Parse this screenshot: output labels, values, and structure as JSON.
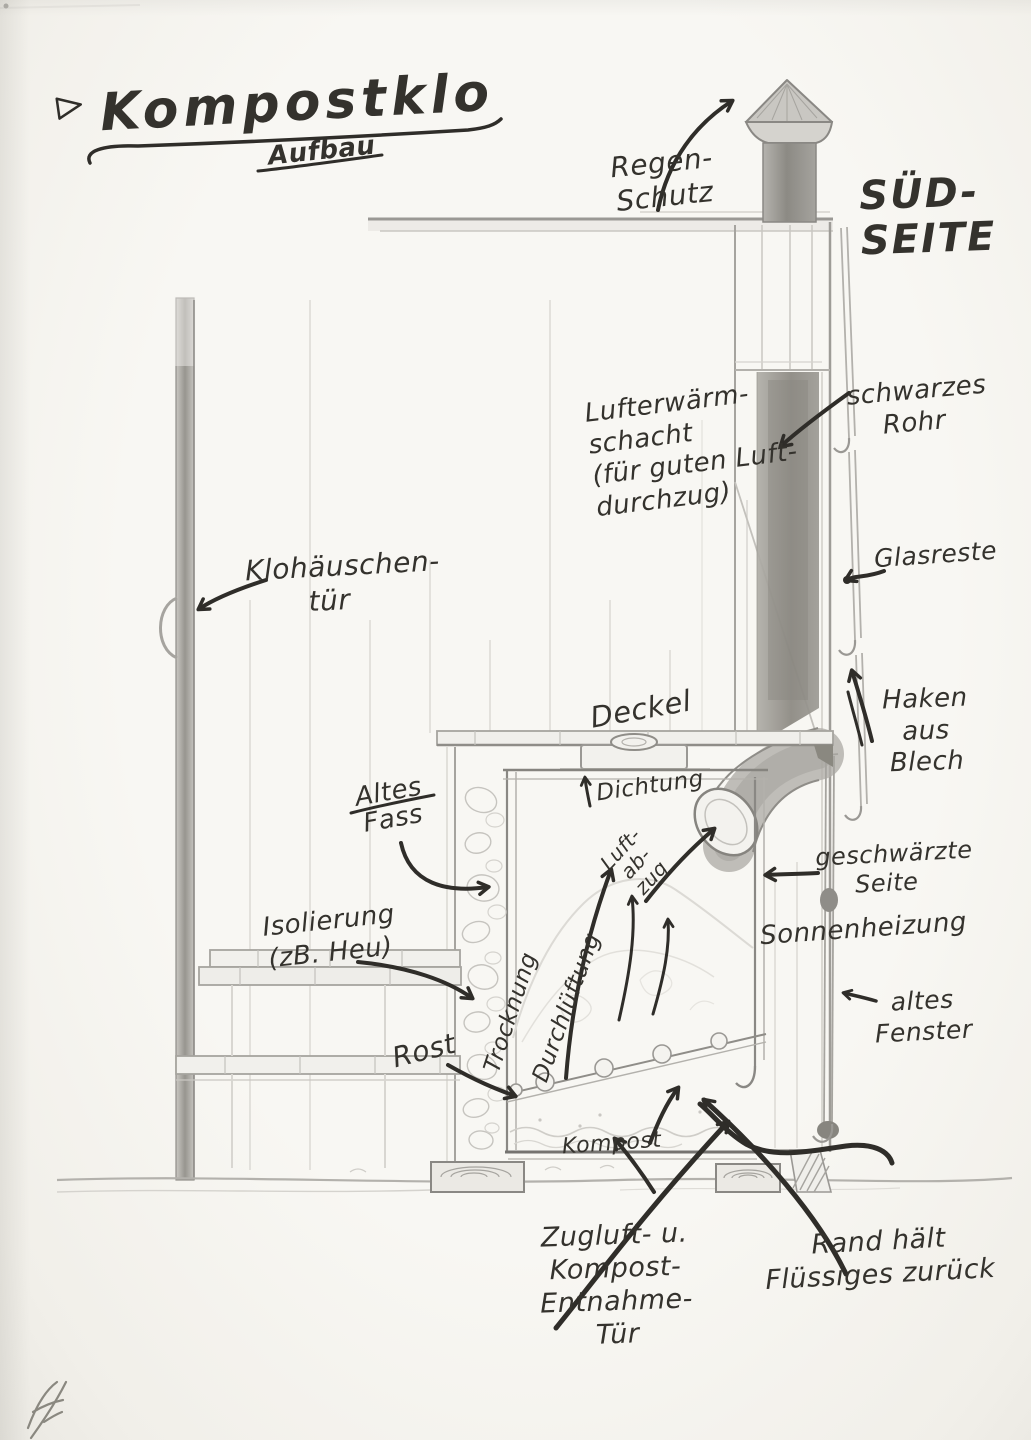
{
  "page": {
    "title": "Kompostklo",
    "subtitle": "Aufbau",
    "side_heading": "SÜD-\nSEITE"
  },
  "labels": {
    "regen_schutz": "Regen-\nSchutz",
    "lufterwaermschacht": "Lufterwärm-\nschacht\n(für guten Luft-\ndurchzug)",
    "schwarzes_rohr": "schwarzes\nRohr",
    "glasreste": "Glasreste",
    "klohaeuschen_tuer": "Klohäuschen-\ntür",
    "haken_aus_blech": "Haken aus\nBlech",
    "deckel": "Deckel",
    "dichtung": "Dichtung",
    "altes_fass": "Altes\nFass",
    "luft_abzug": "Luft-\nab-\nzug",
    "geschwaerzte_seite": "geschwärzte\nSeite",
    "sonnenheizung": "Sonnenheizung",
    "isolierung": "Isolierung\n(zB. Heu)",
    "trocknung": "Trocknung",
    "durchlueftung": "Durchlüftung",
    "altes_fenster": "altes\nFenster",
    "rost": "Rost",
    "kompost": "Kompost",
    "zugluft_entnahme_tuer": "Zugluft- u.\nKompost-Entnahme-\nTür",
    "rand_haelt": "Rand hält\nFlüssiges zurück"
  },
  "icons": {
    "title_pointer": "triangle-right-icon",
    "signature": "artist-monogram"
  },
  "colors": {
    "paper": "#f6f5f1",
    "pencil_faint": "#d8d6d1",
    "pencil_mid": "#a6a49f",
    "pencil_dark": "#8a8884",
    "ink": "#2f2d29"
  }
}
